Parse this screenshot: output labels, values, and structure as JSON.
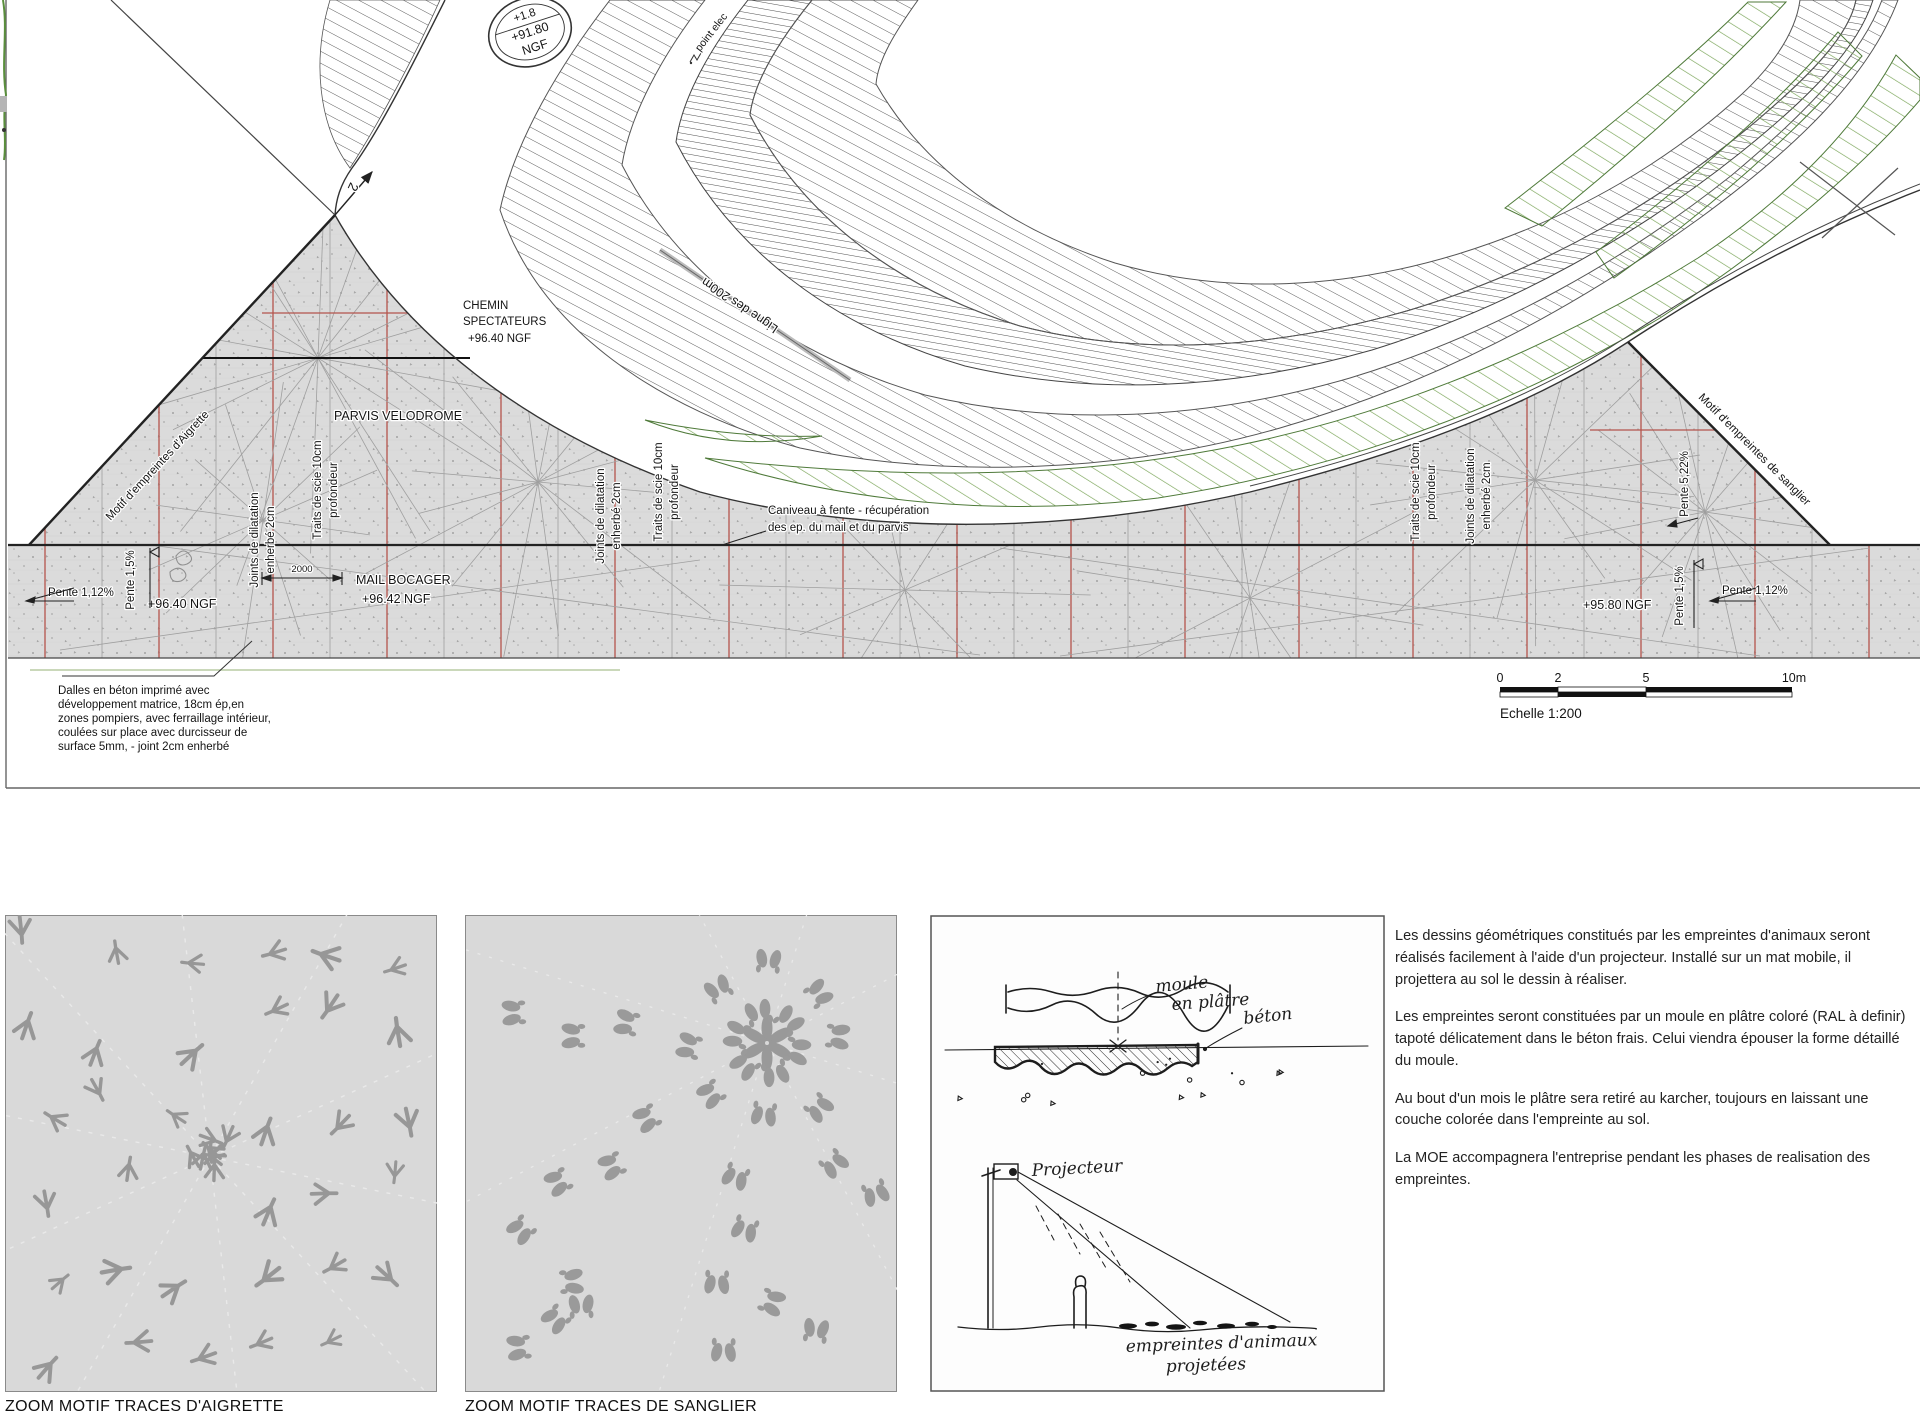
{
  "colors": {
    "concrete": "#dbdbdb",
    "red_joint": "#b4544c",
    "gray_joint": "#ababab",
    "green_hatch": "#79a457",
    "hatch_dark": "#4a4a4a",
    "print_gray": "#9a9a9a"
  },
  "plan": {
    "badge": {
      "line1": "+1.8",
      "line2": "+91.80",
      "line3": "NGF"
    },
    "labels": {
      "point_elec": "point elec",
      "section2": "2",
      "ligne200": "Ligne des 200m",
      "chemin1": "CHEMIN",
      "chemin2": "SPECTATEURS",
      "chemin3": "+96.40 NGF",
      "parvis": "PARVIS VELODROME",
      "aigrette": "Motif d'empreintes d'Aigrette",
      "sanglier": "Motif d'empreintes de sanglier",
      "joints_a": "Joints de dilatation",
      "joints_b": "enherbé 2cm",
      "traits_a": "Traits de scie 10cm",
      "traits_b": "profondeur",
      "pente112": "Pente 1,12%",
      "pente15": "Pente 1,5%",
      "pente522": "Pente 5,22%",
      "mail_ngf": "+96.40 NGF",
      "mail1": "MAIL BOCAGER",
      "mail2": "+96.42 NGF",
      "dim2000": "2000",
      "caniveau1": "Caniveau à fente - récupération",
      "caniveau2": "des ep. du mail et du parvis",
      "ngf9580": "+95.80 NGF"
    },
    "note_dalles": [
      "Dalles en béton imprimé avec",
      "développement matrice, 18cm ép,en",
      "zones pompiers, avec ferraillage intérieur,",
      "coulées sur place avec durcisseur de",
      "surface 5mm, - joint 2cm enherbé"
    ],
    "scale": {
      "t0": "0",
      "t2": "2",
      "t5": "5",
      "t10": "10m",
      "caption": "Echelle 1:200"
    }
  },
  "panels": {
    "aigrette_caption": "ZOOM MOTIF TRACES D'AIGRETTE",
    "sanglier_caption": "ZOOM MOTIF TRACES DE SANGLIER",
    "egret_prints": 34,
    "egret_cluster": 8,
    "boar_trails": 8
  },
  "sketch": {
    "moule1": "moule",
    "moule2": "en plâtre",
    "beton": "béton",
    "projecteur": "Projecteur",
    "emp1": "empreintes d'animaux",
    "emp2": "projetées"
  },
  "text_block": {
    "paragraphs": [
      "Les dessins géométriques constitués par les empreintes d'animaux seront réalisés facilement à l'aide d'un projecteur. Installé sur un mat mobile, il projettera au sol le dessin à réaliser.",
      "Les empreintes seront constituées par un moule en plâtre coloré (RAL à definir) tapoté délicatement dans le béton frais. Celui viendra épouser la forme détaillé du moule.",
      "Au bout d'un mois le plâtre sera retiré au karcher, toujours en laissant une couche colorée dans l'empreinte au sol.",
      "La MOE accompagnera l'entreprise pendant les phases de realisation des empreintes."
    ]
  }
}
